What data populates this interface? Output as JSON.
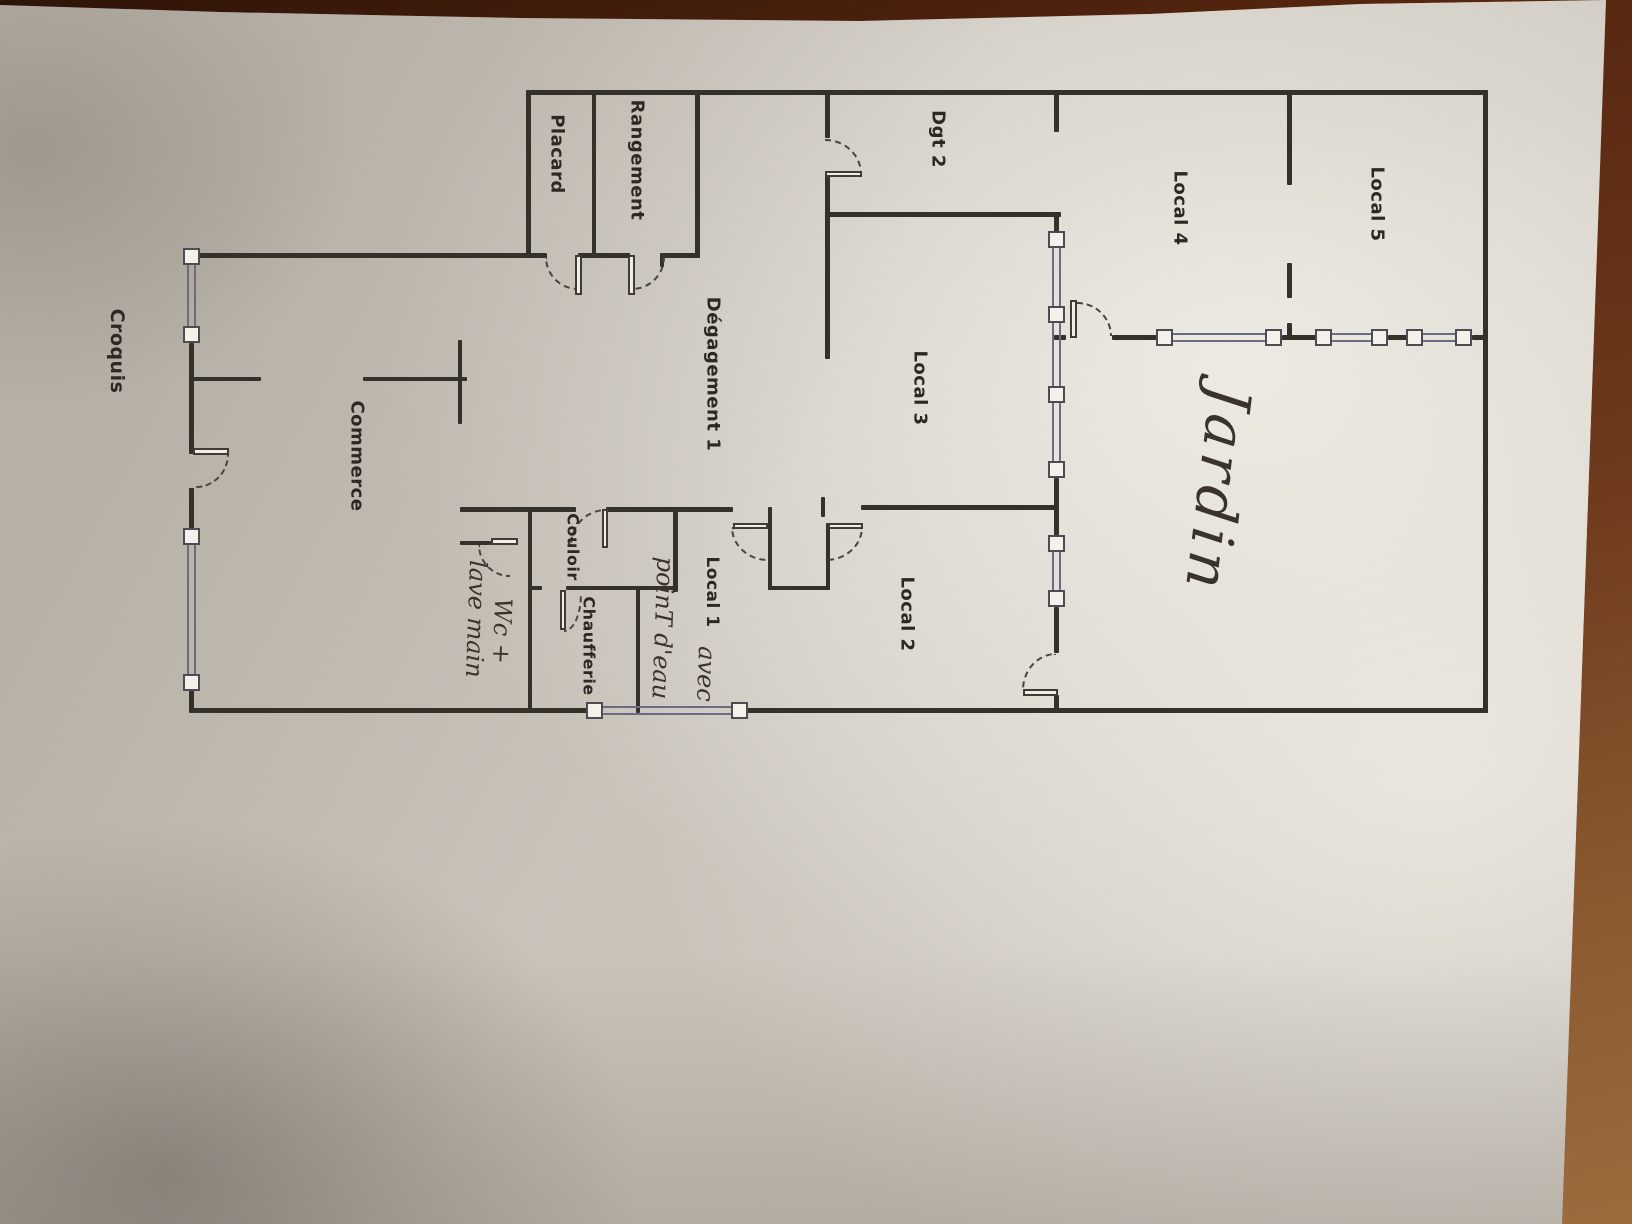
{
  "document_title": "Croquis",
  "colors": {
    "table_wood": "#6e3a1c",
    "paper": "#e8e4dd",
    "wall_ink": "#34302a",
    "window_ink": "#6c6b84",
    "door_dash": "#49443d",
    "print_text": "#2d2822",
    "script_text": "#3a332b"
  },
  "plan": {
    "labels": [
      {
        "id": "croquis",
        "text": "Croquis",
        "x": 117,
        "y": 351,
        "kind": "print",
        "size": 19,
        "rot": 90
      },
      {
        "id": "placard",
        "text": "Placard",
        "x": 557,
        "y": 154,
        "kind": "print",
        "size": 18,
        "rot": 90
      },
      {
        "id": "rangement",
        "text": "Rangement",
        "x": 637,
        "y": 160,
        "kind": "print",
        "size": 18,
        "rot": 90
      },
      {
        "id": "dgt-2",
        "text": "Dgt 2",
        "x": 938,
        "y": 139,
        "kind": "print",
        "size": 18,
        "rot": 90
      },
      {
        "id": "local-4",
        "text": "Local 4",
        "x": 1180,
        "y": 208,
        "kind": "print",
        "size": 18,
        "rot": 90
      },
      {
        "id": "local-5",
        "text": "Local 5",
        "x": 1377,
        "y": 204,
        "kind": "print",
        "size": 18,
        "rot": 90
      },
      {
        "id": "degagement-1",
        "text": "Dégagement 1",
        "x": 713,
        "y": 374,
        "kind": "print",
        "size": 18,
        "rot": 90
      },
      {
        "id": "local-3",
        "text": "Local 3",
        "x": 920,
        "y": 388,
        "kind": "print",
        "size": 18,
        "rot": 90
      },
      {
        "id": "commerce",
        "text": "Commerce",
        "x": 357,
        "y": 456,
        "kind": "print",
        "size": 18,
        "rot": 90
      },
      {
        "id": "couloir",
        "text": "Couloir",
        "x": 573,
        "y": 547,
        "kind": "print",
        "size": 16,
        "rot": 90
      },
      {
        "id": "chaufferie",
        "text": "Chaufferie",
        "x": 589,
        "y": 646,
        "kind": "print",
        "size": 16,
        "rot": 90
      },
      {
        "id": "local-1",
        "text": "Local 1",
        "x": 712,
        "y": 592,
        "kind": "print",
        "size": 17,
        "rot": 90
      },
      {
        "id": "avec",
        "text": "avec",
        "x": 706,
        "y": 674,
        "kind": "script",
        "size": 24,
        "rot": 92
      },
      {
        "id": "point-eau",
        "text": "poinT d'eau",
        "x": 663,
        "y": 628,
        "kind": "script",
        "size": 24,
        "rot": 92
      },
      {
        "id": "local-2",
        "text": "Local 2",
        "x": 907,
        "y": 614,
        "kind": "print",
        "size": 18,
        "rot": 90
      },
      {
        "id": "wc-lave-main-1",
        "text": "Wc +",
        "x": 502,
        "y": 631,
        "kind": "script",
        "size": 24,
        "rot": 92
      },
      {
        "id": "wc-lave-main-2",
        "text": "lave main",
        "x": 476,
        "y": 619,
        "kind": "script",
        "size": 24,
        "rot": 92
      },
      {
        "id": "jardin",
        "text": "Jardin",
        "x": 1218,
        "y": 490,
        "kind": "script",
        "size": 58,
        "rot": 97
      }
    ],
    "walls": [
      [
        526,
        90,
        962,
        5
      ],
      [
        1483,
        90,
        5,
        623
      ],
      [
        189,
        708,
        399,
        5
      ],
      [
        746,
        708,
        742,
        5
      ],
      [
        189,
        343,
        5,
        111
      ],
      [
        189,
        488,
        5,
        44
      ],
      [
        189,
        690,
        5,
        22
      ],
      [
        1054,
        90,
        5,
        42
      ],
      [
        1054,
        212,
        5,
        21
      ],
      [
        1054,
        478,
        5,
        60
      ],
      [
        1054,
        607,
        5,
        46
      ],
      [
        1054,
        695,
        5,
        17
      ],
      [
        1054,
        335,
        12,
        5
      ],
      [
        1112,
        335,
        47,
        5
      ],
      [
        1282,
        335,
        36,
        5
      ],
      [
        1388,
        335,
        21,
        5
      ],
      [
        1472,
        335,
        16,
        5
      ],
      [
        191,
        253,
        340,
        5
      ],
      [
        526,
        90,
        5,
        168
      ],
      [
        592,
        90,
        4,
        167
      ],
      [
        695,
        90,
        5,
        168
      ],
      [
        526,
        253,
        21,
        5
      ],
      [
        578,
        253,
        52,
        5
      ],
      [
        663,
        253,
        37,
        5
      ],
      [
        660,
        253,
        4,
        14
      ],
      [
        825,
        90,
        5,
        48
      ],
      [
        825,
        176,
        5,
        183
      ],
      [
        825,
        212,
        236,
        5
      ],
      [
        861,
        505,
        195,
        5
      ],
      [
        821,
        497,
        4,
        20
      ],
      [
        460,
        507,
        116,
        5
      ],
      [
        606,
        507,
        127,
        5
      ],
      [
        768,
        507,
        4,
        83
      ],
      [
        768,
        586,
        62,
        4
      ],
      [
        826,
        523,
        4,
        67
      ],
      [
        460,
        541,
        31,
        4
      ],
      [
        528,
        507,
        4,
        38
      ],
      [
        528,
        541,
        4,
        172
      ],
      [
        528,
        586,
        14,
        4
      ],
      [
        566,
        586,
        111,
        4
      ],
      [
        636,
        586,
        4,
        127
      ],
      [
        673,
        507,
        5,
        85
      ],
      [
        191,
        377,
        70,
        4
      ],
      [
        363,
        377,
        104,
        4
      ],
      [
        458,
        340,
        4,
        84
      ],
      [
        1287,
        90,
        5,
        95
      ],
      [
        1287,
        263,
        5,
        35
      ],
      [
        1287,
        323,
        5,
        17
      ]
    ],
    "window_boxes": [
      [
        183,
        248
      ],
      [
        183,
        326
      ],
      [
        183,
        528
      ],
      [
        183,
        674
      ],
      [
        1048,
        231
      ],
      [
        1048,
        306
      ],
      [
        1048,
        386
      ],
      [
        1048,
        461
      ],
      [
        1048,
        535
      ],
      [
        1048,
        590
      ],
      [
        1156,
        329
      ],
      [
        1265,
        329
      ],
      [
        1315,
        329
      ],
      [
        1371,
        329
      ],
      [
        1406,
        329
      ],
      [
        1455,
        329
      ],
      [
        586,
        702
      ],
      [
        731,
        702
      ]
    ],
    "glazings": [
      [
        187,
        264,
        9,
        63,
        "v"
      ],
      [
        187,
        544,
        9,
        131,
        "v"
      ],
      [
        1052,
        247,
        9,
        60,
        "v"
      ],
      [
        1052,
        322,
        9,
        65,
        "v"
      ],
      [
        1052,
        402,
        9,
        60,
        "v"
      ],
      [
        1052,
        551,
        9,
        40,
        "v"
      ],
      [
        1172,
        333,
        94,
        9,
        "h"
      ],
      [
        1331,
        333,
        41,
        9,
        "h"
      ],
      [
        1422,
        333,
        34,
        9,
        "h"
      ],
      [
        602,
        706,
        130,
        9,
        "h"
      ]
    ],
    "door_leaves": [
      [
        193,
        448,
        36,
        7
      ],
      [
        575,
        255,
        7,
        40
      ],
      [
        628,
        255,
        7,
        40
      ],
      [
        825,
        171,
        37,
        6
      ],
      [
        602,
        509,
        6,
        39
      ],
      [
        491,
        538,
        27,
        7
      ],
      [
        560,
        590,
        6,
        40
      ],
      [
        733,
        523,
        35,
        6
      ],
      [
        828,
        523,
        35,
        6
      ],
      [
        1070,
        300,
        7,
        38
      ],
      [
        1023,
        689,
        35,
        7
      ]
    ],
    "door_arcs": [
      [
        196,
        454,
        33,
        34,
        "br"
      ],
      [
        545,
        257,
        33,
        33,
        "bl"
      ],
      [
        632,
        257,
        33,
        33,
        "br"
      ],
      [
        825,
        139,
        37,
        35,
        "tr"
      ],
      [
        570,
        509,
        36,
        36,
        "tl"
      ],
      [
        478,
        545,
        32,
        32,
        "bl"
      ],
      [
        564,
        594,
        18,
        38,
        "br"
      ],
      [
        731,
        527,
        37,
        34,
        "bl"
      ],
      [
        826,
        527,
        37,
        34,
        "br"
      ],
      [
        1077,
        302,
        35,
        34,
        "tr"
      ],
      [
        1022,
        653,
        34,
        37,
        "tl"
      ]
    ]
  }
}
